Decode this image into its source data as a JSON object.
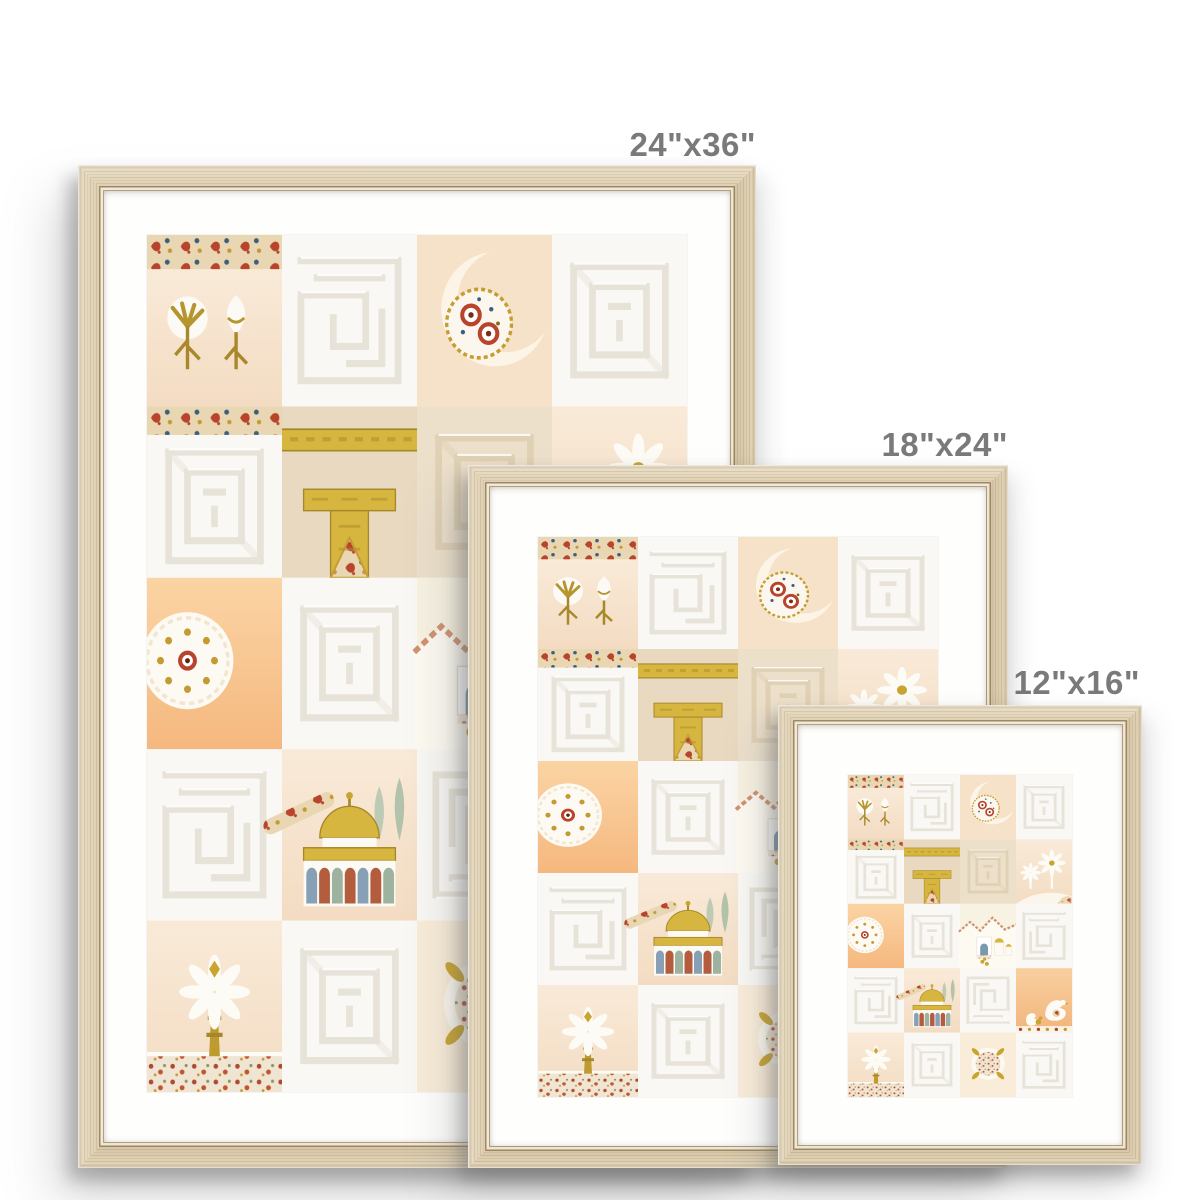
{
  "title": "Framed art print size comparison",
  "frames": [
    {
      "size_label": "24\"x36\""
    },
    {
      "size_label": "18\"x24\""
    },
    {
      "size_label": "12\"x16\""
    }
  ],
  "style": {
    "frame_finish": "natural light wood",
    "mat_color": "#fefefd",
    "label_color": "#7a7a7a",
    "wood_color": "#e2d4b8",
    "gold": "#d6b63e",
    "peach": "#f6e3cc",
    "orange": "#f7c08a",
    "paisley_red": "#b8442c",
    "background": "#ffffff"
  },
  "artwork": {
    "description": "Collage of embossed Islamic art tiles",
    "motifs": [
      "embossed kufic calligraphy squares",
      "paisley textile strips",
      "white carnation and tulip flowers",
      "crescent moon with suzani medallion",
      "Kaaba with gold kiswa band",
      "white palm trees",
      "white medallion on orange",
      "domed village with gold domes",
      "Dome of the Rock with arch colonnade and cypresses",
      "white doves",
      "paisley wreath medallion"
    ]
  }
}
